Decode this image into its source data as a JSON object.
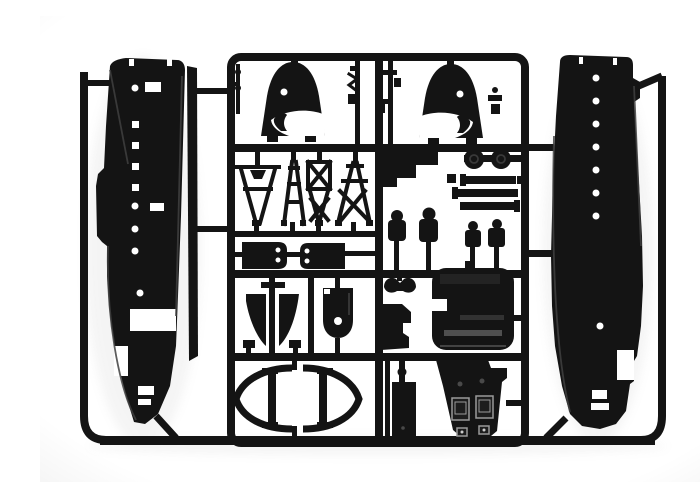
{
  "photo": {
    "alt": "Black injection-molded plastic model kit sprue: two aircraft fuselage halves with window and porthole openings on the left and right, and a central runner frame holding engine cowlings, lattice struts, bulkheads, wheels, seats, panels and other small parts on a white background",
    "colors": {
      "background": "#ffffff",
      "plastic": "#141414",
      "plastic_soft": "#2e2e2e",
      "edge_highlight": "#3f3f3f",
      "detail": "#4f4f4f",
      "metal_light": "#9a9a9a",
      "cutout": "#ffffff",
      "shadow": "#8f8f8f"
    },
    "parts": {
      "frame": "Sprue runner frame",
      "fuselage_left": "Left fuselage half with cabin window openings",
      "fuselage_right": "Right fuselage half with porthole openings",
      "stringer": "Thin stringer strip part",
      "cowling_left": "Engine cowling (left)",
      "cowling_right": "Engine cowling (right)",
      "rod_parts": "Small rod and antenna parts",
      "trusses": "Lattice strut parts",
      "bulkheads": "Bulkhead parts with twin lightening holes",
      "step_part": "Stepped bracket part",
      "wheels": "Paired main wheels on axle",
      "bars": "Stacked spar bar parts",
      "seats": "Crew seat parts",
      "v_part": "Vee-shaped twin blade part",
      "hatch": "Hatch part with porthole",
      "clip": "Curved yoke part",
      "bracket": "Angled bracket part",
      "panel": "Cabin panel part",
      "oval_frames": "Elliptical frame parts",
      "box_part": "Rectangular tank part",
      "floor_part": "Cockpit floor part with seat frames"
    }
  }
}
